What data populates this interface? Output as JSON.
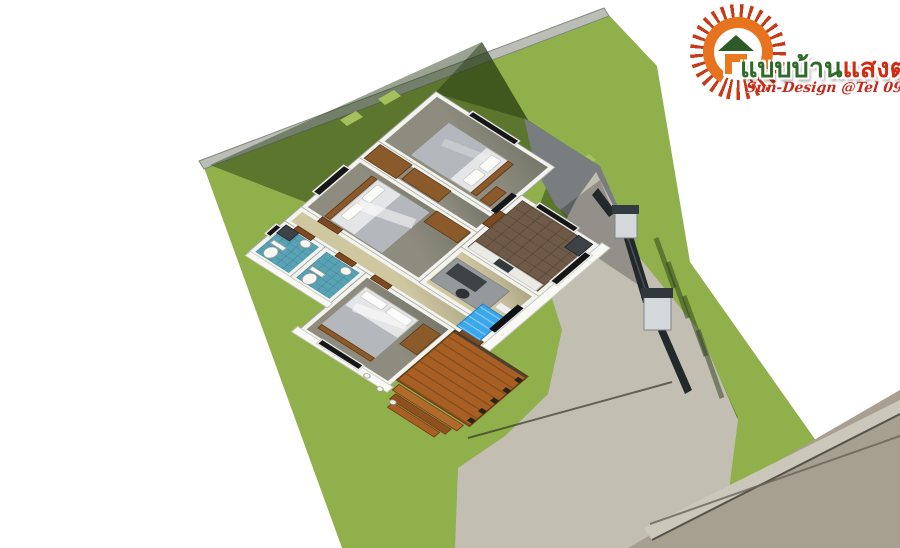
{
  "meta": {
    "type": "3d-floor-plan-aerial-rendering",
    "description": "Aerial 3D rendering of a single-storey 3-bedroom 2-bathroom house on a green lawn with wood deck, concrete driveway, entrance gate and road"
  },
  "logo": {
    "icon": "sun-house-logo",
    "name_green": "แบบบ้าน",
    "name_red": "แสงตะวัน",
    "tagline": "Sun-Design @Tel 098.1647-662",
    "colors": {
      "name_green": "#2f6b28",
      "name_red": "#d02c12",
      "tagline": "#c6281c",
      "sun": "#e8731f",
      "rays": "#c63a18",
      "roof": "#2d5b28"
    }
  },
  "site": {
    "lawn_color": "#8fb04a",
    "lawn_shadow_color": "#52702e",
    "boundary_wall_color": "#babeb7",
    "patio_concrete_shadow_color": "#797d7f",
    "driveway_color": "#c2beb2",
    "road_color": "#a79f90",
    "curb_color": "#ccc7bb",
    "gate_post_color": "#d5d8da",
    "gate_fence_color": "#23282c"
  },
  "house": {
    "wall_color": "#f2f2ef",
    "rooms": [
      {
        "name": "bedroom-top",
        "floor_color": "#8d8c7e",
        "furniture": [
          "double-bed",
          "tv-panel",
          "dresser",
          "window"
        ]
      },
      {
        "name": "closet-nook",
        "floor_color": "#8d8c7e",
        "furniture": [
          "wardrobe",
          "wardrobe"
        ]
      },
      {
        "name": "bedroom-left",
        "floor_color": "#8d8c7e",
        "furniture": [
          "double-bed",
          "wardrobe",
          "window"
        ]
      },
      {
        "name": "hallway",
        "floor_color": "#cfc7a0",
        "furniture": [
          "doors"
        ]
      },
      {
        "name": "bathroom-1",
        "floor_color": "#57a3b5",
        "furniture": [
          "toilet",
          "sink",
          "washer"
        ]
      },
      {
        "name": "bathroom-2",
        "floor_color": "#57a3b5",
        "furniture": [
          "toilet",
          "sink"
        ]
      },
      {
        "name": "bedroom-bottom",
        "floor_color": "#8d8c7e",
        "furniture": [
          "double-bed",
          "cabinet",
          "window"
        ]
      },
      {
        "name": "kitchen",
        "floor_color": "#6e5a46",
        "furniture": [
          "counter",
          "stove",
          "fridge",
          "window",
          "window"
        ]
      },
      {
        "name": "living-area",
        "floor_color": "#cfc7a0",
        "furniture": [
          "rug",
          "desk",
          "office-chair",
          "blue-sofa",
          "shelf",
          "tv-panel"
        ]
      },
      {
        "name": "wood-deck",
        "floor_color": "#a85f24",
        "furniture": [
          "steps",
          "railing-posts",
          "porch-columns"
        ]
      }
    ]
  }
}
